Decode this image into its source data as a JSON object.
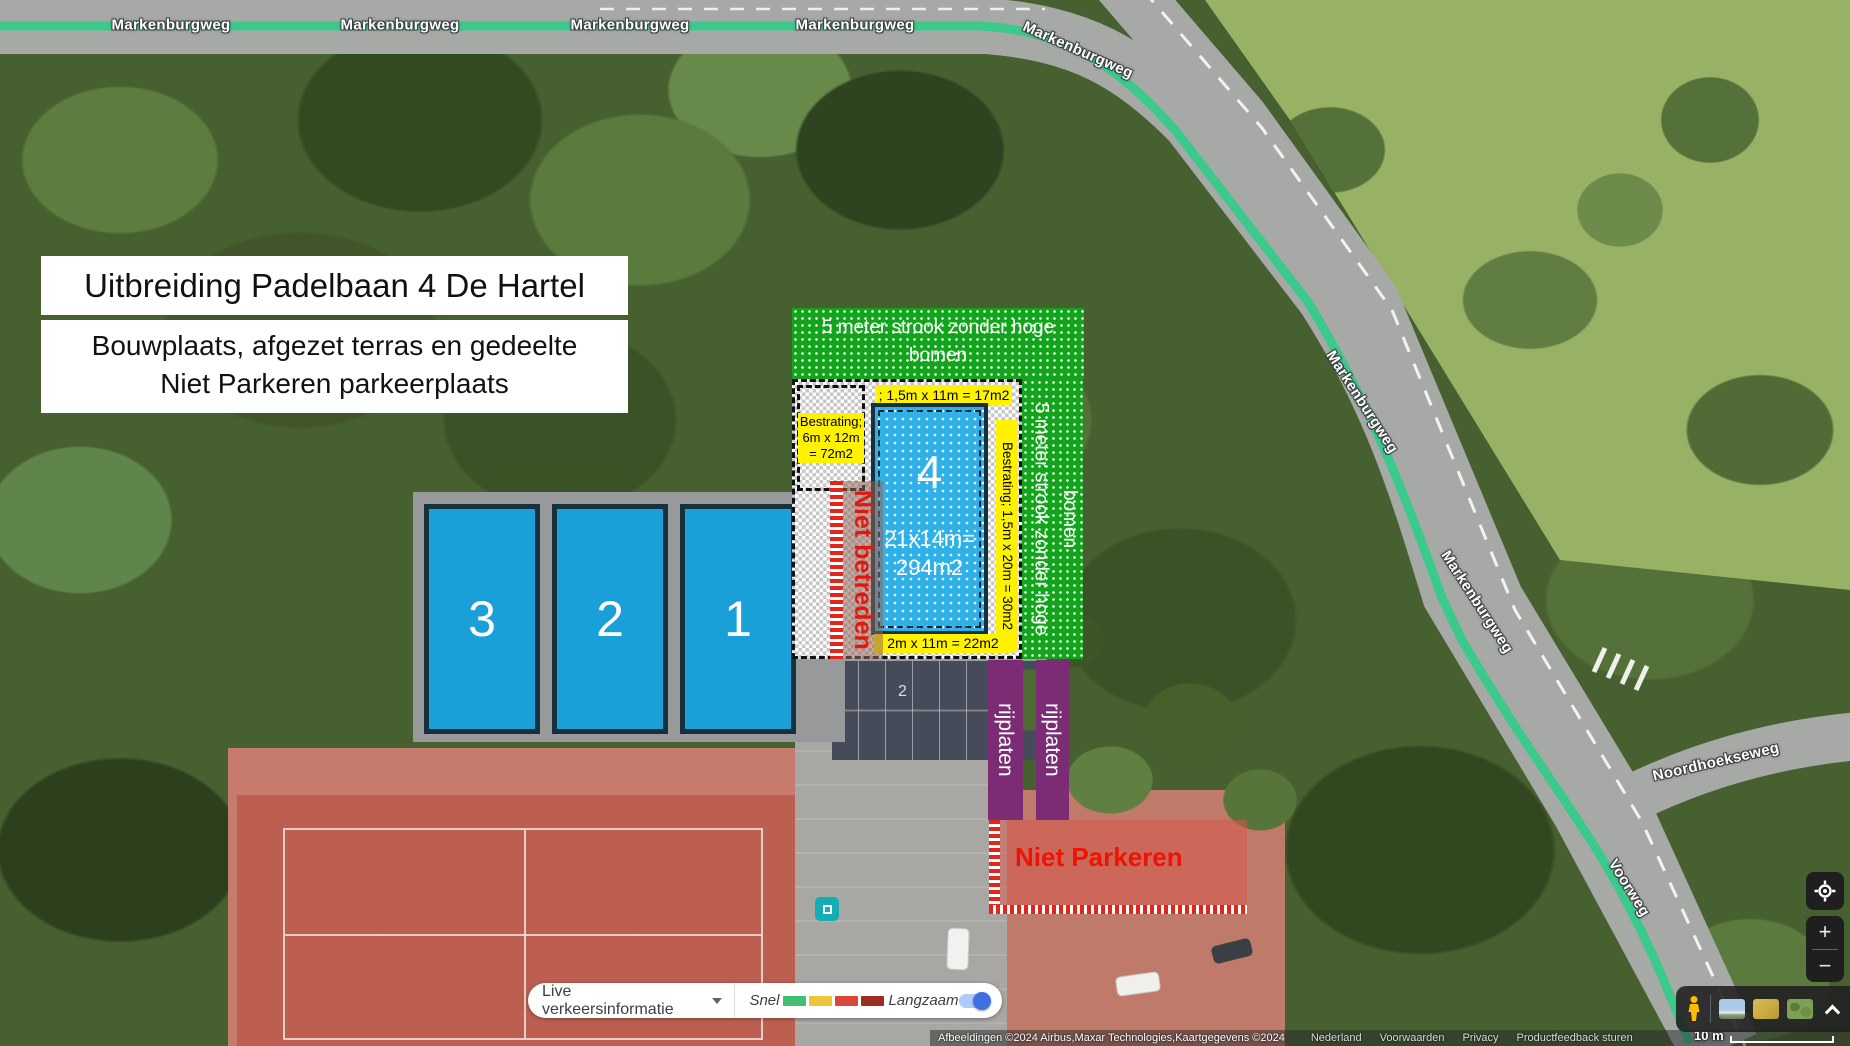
{
  "title_box": {
    "line1": "Uitbreiding Padelbaan 4 De Hartel"
  },
  "subtitle_box": {
    "line1": "Bouwplaats, afgezet terras en gedeelte",
    "line2": "Niet Parkeren parkeerplaats"
  },
  "overlay": {
    "green_strip_top": "5 meter strook zonder hoge bomen",
    "green_strip_right": "5 meter strook zonder hoge bomen",
    "label_bestrating_left": "Bestrating; 6m x 12m = 72m2",
    "label_top": "; 1,5m x 11m = 17m2",
    "label_right_vertical": "Bestrating; 1,5m x 20m = 30m2",
    "label_bottom": "2m x 11m = 22m2",
    "court4": {
      "number": "4",
      "dim_line1": "21x14m=",
      "dim_line2": "294m2"
    },
    "courts": [
      {
        "number": "3"
      },
      {
        "number": "2"
      },
      {
        "number": "1"
      }
    ],
    "niet_betreden": "Niet betreden",
    "rijplaten_left": "rijplaten",
    "rijplaten_right": "rijplaten",
    "niet_parkeren": "Niet Parkeren",
    "parking_spot_label": "2",
    "colors": {
      "court_blue": "#1aa0d8",
      "strip_green": "#12a51c",
      "label_yellow": "#fff200",
      "rijplaten_purple": "#7b2c74",
      "warning_red": "#e2261c"
    }
  },
  "roads": {
    "markenburgweg_labels": [
      "Markenburgweg",
      "Markenburgweg",
      "Markenburgweg",
      "Markenburgweg",
      "Markenburgweg",
      "Markenburgweg",
      "Markenburgweg"
    ],
    "noordhoekseweg": "Noordhoekseweg",
    "voorweg": "Voorweg",
    "traffic_line_color": "#3bc98c"
  },
  "traffic_control": {
    "dropdown_label": "Live verkeersinformatie",
    "fast_label": "Snel",
    "slow_label": "Langzaam",
    "legend_colors": [
      "#41be71",
      "#efc439",
      "#dc4639",
      "#9b2d21"
    ],
    "toggle_state": "on"
  },
  "attribution": {
    "imagery": "Afbeeldingen ©2024 Airbus,Maxar Technologies,Kaartgegevens ©2024",
    "links": [
      "Nederland",
      "Voorwaarden",
      "Privacy",
      "Productfeedback sturen"
    ],
    "scale_label": "10 m"
  },
  "map_controls": {
    "zoom_in": "+",
    "zoom_out": "−"
  }
}
